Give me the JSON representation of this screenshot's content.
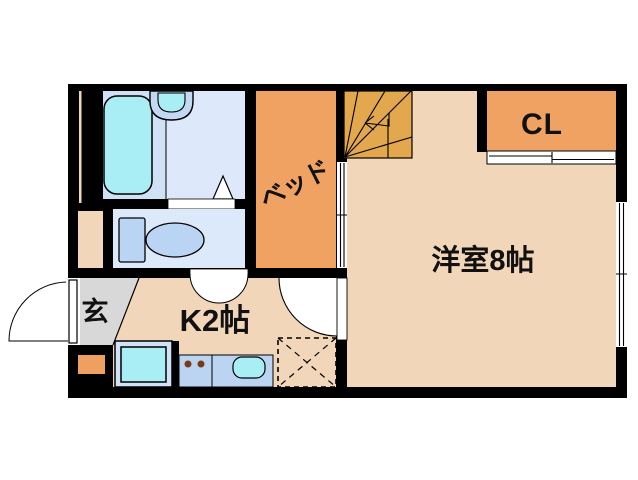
{
  "floor_plan": {
    "title": "1K apartment floor plan",
    "rooms": {
      "western_room_label": "洋室8帖",
      "kitchen_label": "K2帖",
      "closet_label": "CL",
      "entrance_label": "玄",
      "bed_space_label": "ベッド"
    },
    "colors": {
      "wall": "#000000",
      "room_floor": "#f2d6b9",
      "bed_space": "#f0a263",
      "closet": "#f0a263",
      "stairs": "#e3a74d",
      "accent_square": "#ef9f60",
      "bath_floor": "#cfe1f5",
      "washroom_floor": "#dde9fb",
      "toilet_floor": "#dce9fa",
      "fixture_cyan": "#a9eef4",
      "fixture_blue": "#bad5f3",
      "counter_blue": "#bad4f2",
      "sink_outer_blue": "#c3d9f2",
      "fridge_frame_blue": "#cfe2f6",
      "entrance_floor": "#d8d8d8",
      "burner_dot": "#7a3a16",
      "background": "#ffffff"
    }
  }
}
